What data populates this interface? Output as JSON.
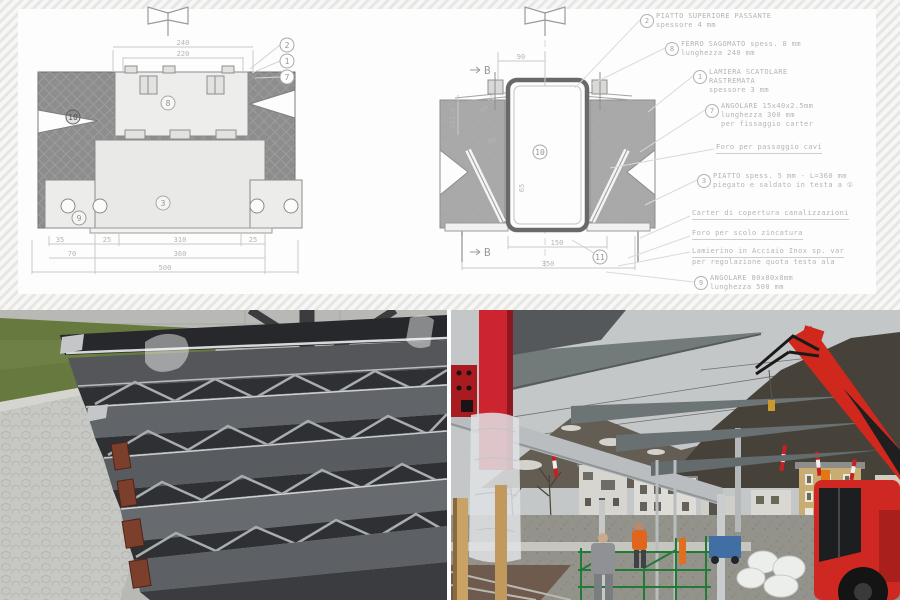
{
  "drawing_panel": {
    "left_view": {
      "dims": {
        "top1": "240",
        "top2": "220",
        "r1a": "35",
        "r1b": "25",
        "r1c": "310",
        "r1d": "25",
        "r2a": "70",
        "r2b": "360",
        "r3": "500"
      },
      "callouts": {
        "c2": "2",
        "c1": "1",
        "c7": "7",
        "c8": "8",
        "c3": "3",
        "c9": "9",
        "c10": "10"
      }
    },
    "right_view": {
      "marker": "B",
      "dims": {
        "top": "90",
        "angle": "94.6°",
        "height": "162.6",
        "d80": "80",
        "d65": "65",
        "inner": "150",
        "outer": "350"
      },
      "callouts": {
        "c10": "10",
        "c11": "11"
      }
    },
    "annotations": [
      {
        "num": "2",
        "l1": "PIATTO SUPERIORE PASSANTE",
        "l2": "spessore 4 mm"
      },
      {
        "num": "8",
        "l1": "FERRO SAGOMATO spess. 8 mm",
        "l2": "lunghezza 240 mm"
      },
      {
        "num": "1",
        "l1": "LAMIERA SCATOLARE",
        "l2": "RASTREMATA",
        "l3": "spessore 3 mm"
      },
      {
        "num": "7",
        "l1": "ANGOLARE 15x40x2.5mm",
        "l2": "lunghezza 300 mm",
        "l3": "per fissaggio carter"
      },
      {
        "l1": "Foro per passaggio cavi"
      },
      {
        "num": "3",
        "l1": "PIATTO spess. 5 mm - L=360 mm",
        "l2": "piegato e saldato in testa a ①"
      },
      {
        "l1": "Carter di copertura canalizzazioni"
      },
      {
        "l1": "Foro per scolo zincatura"
      },
      {
        "l1": "Lamierino in Acciaio Inox sp. var",
        "l2": "per regolazione quota testa ala"
      },
      {
        "num": "9",
        "l1": "ANGOLARE 80x80x8mm",
        "l2": "lunghezza 500 mm"
      }
    ]
  },
  "photos": {
    "left": {
      "alt": "stacked tapered steel canopy beams in yard",
      "colors": {
        "pavement": "#c7c7c3",
        "grass": "#66793f",
        "wall": "#b8b8b4",
        "steel_dark": "#54565a",
        "rust_clamp": "#7c3f2c"
      }
    },
    "right": {
      "alt": "site erection of steel canopy wings with red telescopic crane",
      "colors": {
        "sky": "#c4c7c7",
        "mountain": "#474239",
        "crane_red": "#cf2823",
        "scaffold_green": "#237a36",
        "safety_orange": "#e0651e",
        "building_yellow": "#c7ad72"
      }
    }
  }
}
